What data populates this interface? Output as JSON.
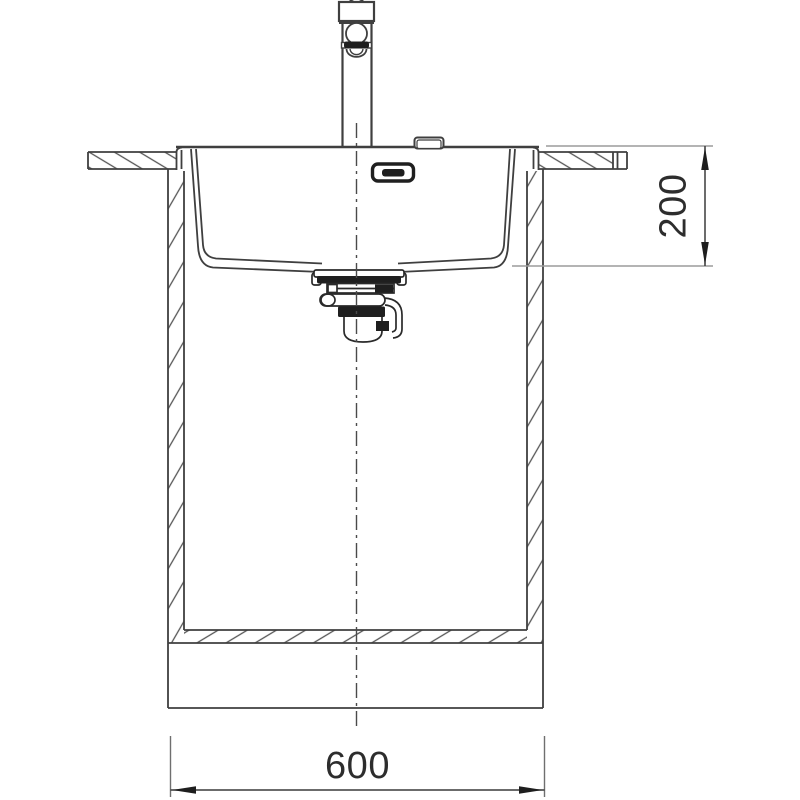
{
  "drawing": {
    "background": "#ffffff",
    "line_color": "#3f3f3f",
    "hatch_color": "#555555",
    "extension_line_color": "#9b9b9b",
    "dark_fill": "#1f1f1f",
    "dimension_text_color": "#2d2d2d",
    "dimensions": {
      "depth": "200",
      "width": "600"
    },
    "parts": [
      "mixer-tap",
      "tap-hole-cover",
      "overflow-outlet",
      "sink-bowl",
      "countertop-left",
      "countertop-right",
      "base-cabinet",
      "drain-strainer",
      "siphon-trap",
      "center-line",
      "depth-dimension",
      "width-dimension"
    ]
  }
}
